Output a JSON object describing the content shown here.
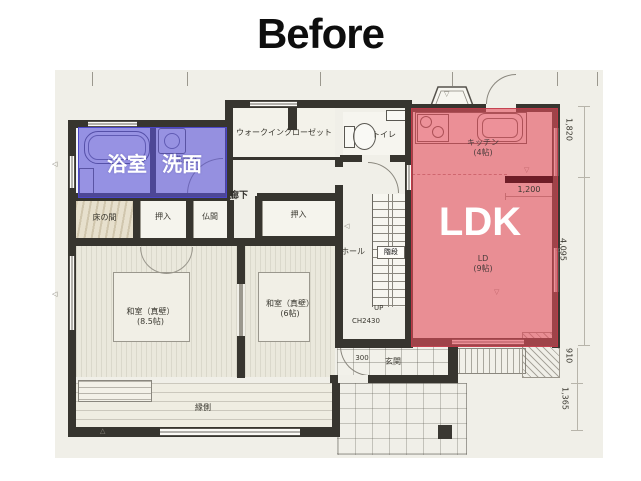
{
  "title": "Before",
  "overlays": {
    "bath_label": "浴室",
    "wash_label": "洗面",
    "ldk_label": "LDK",
    "blue_color": "#5a52d7",
    "red_color": "#e44d5c"
  },
  "labels": {
    "wic": "ウォークインクローゼット",
    "toilet": "トイレ",
    "hallway": "廊下",
    "tokonoma": "床の間",
    "oshiire_a": "押入",
    "butsuma": "仏間",
    "oshiire_b": "押入",
    "washitsu_a_1": "和室（真壁）",
    "washitsu_a_2": "(8.5帖)",
    "washitsu_b_1": "和室（真壁）",
    "washitsu_b_2": "(6帖)",
    "hall": "ホール",
    "stairs": "階段",
    "up": "UP",
    "ceiling_height": "CH2430",
    "kitchen_1": "キッチン",
    "kitchen_2": "(4帖)",
    "ld_1": "LD",
    "ld_2": "(9帖)",
    "genkan": "玄関",
    "engawa": "縁側",
    "washroom_small": "洗面室"
  },
  "dimensions": {
    "d1820": "1,820",
    "d1200": "1,200",
    "d4095": "4,095",
    "d910": "910",
    "d1365": "1,365",
    "d300": "300"
  },
  "markers": {
    "left": "◁",
    "down": "▽",
    "up": "△"
  }
}
